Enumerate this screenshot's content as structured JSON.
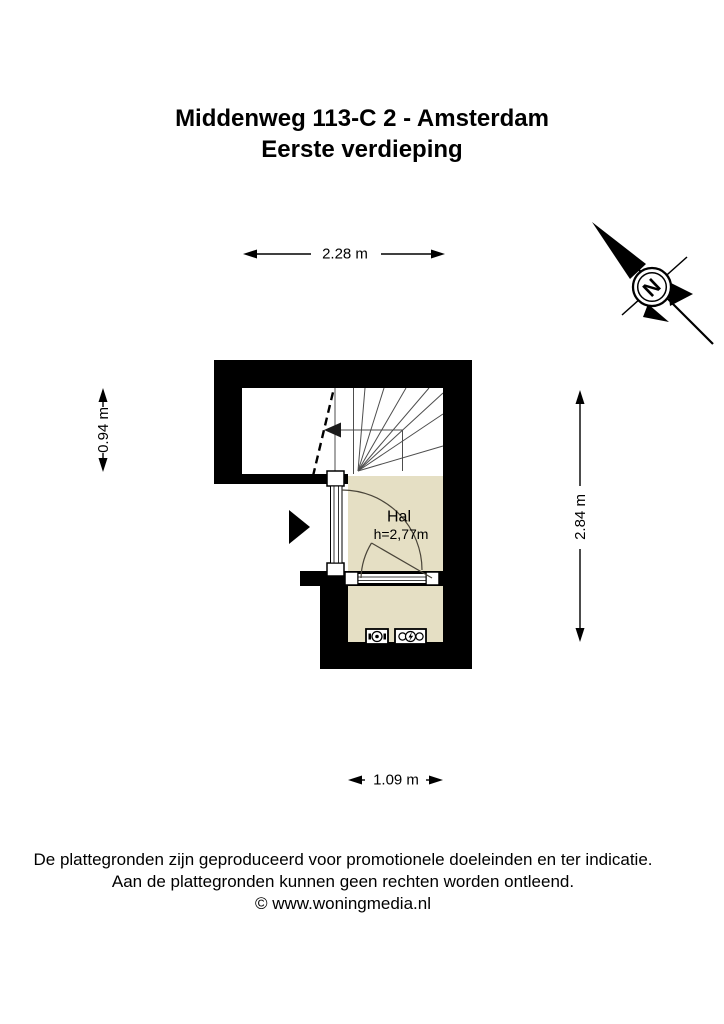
{
  "title": {
    "line1": "Middenweg 113-C 2 - Amsterdam",
    "line2": "Eerste verdieping"
  },
  "floorplan": {
    "room": {
      "name": "Hal",
      "ceiling_height": "h=2,77m"
    },
    "dimensions": {
      "top": "2.28 m",
      "left": "0.94 m",
      "right": "2.84 m",
      "bottom": "1.09 m"
    },
    "compass": {
      "north_letter": "N"
    },
    "colors": {
      "wall": "#000000",
      "floor": "#e5dfc4",
      "swing_line": "#4a453a"
    }
  },
  "footer": {
    "line1": "De plattegronden zijn geproduceerd voor promotionele doeleinden en ter indicatie.",
    "line2": "Aan de plattegronden kunnen geen rechten worden ontleend.",
    "line3": "© www.woningmedia.nl"
  }
}
